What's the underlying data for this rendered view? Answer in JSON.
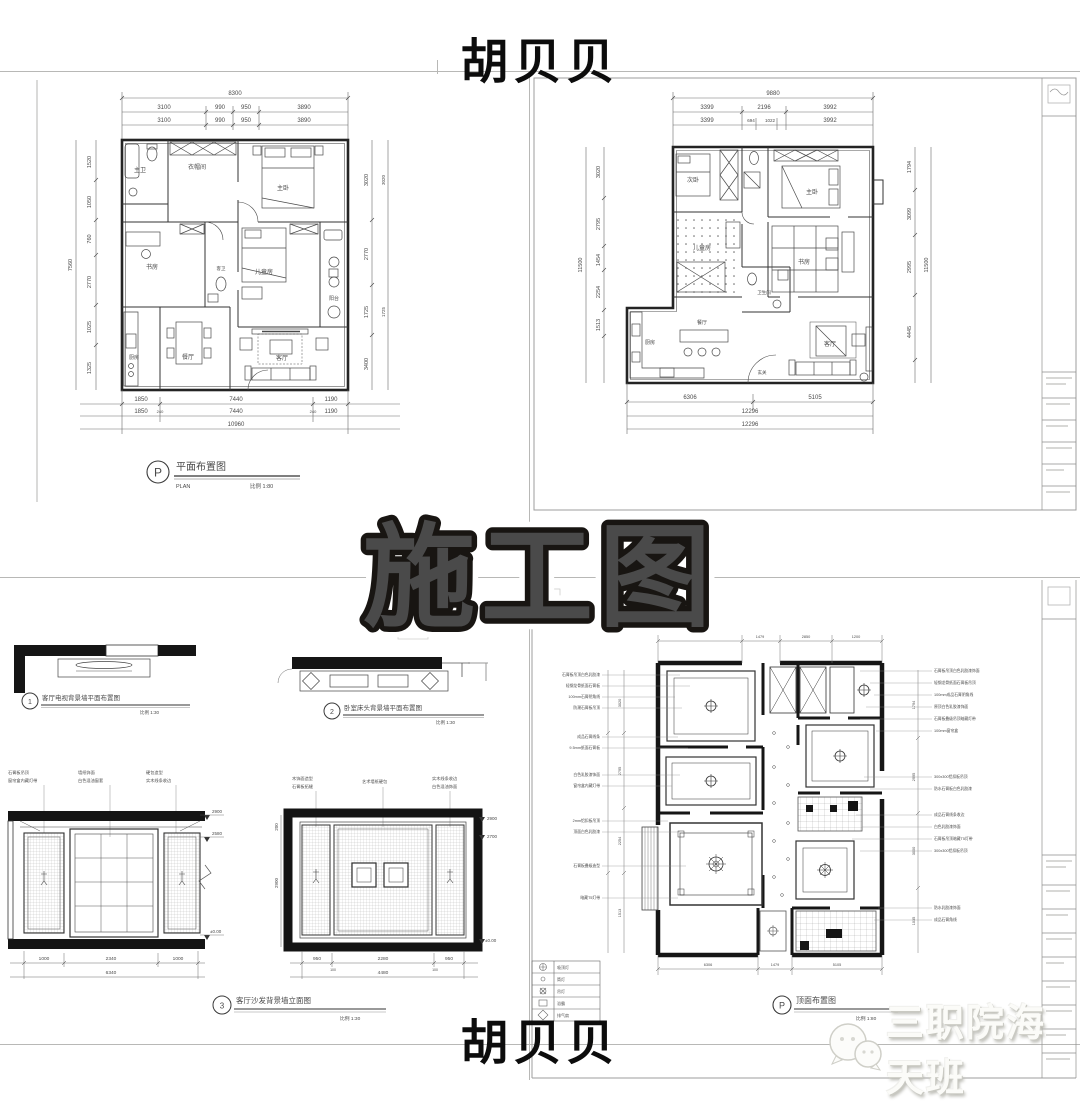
{
  "page": {
    "top_name": "胡贝贝",
    "bottom_name": "胡贝贝",
    "banner": "施工图",
    "watermark_text": "三职院海天班",
    "logo": "wechat-icon",
    "colors": {
      "banner_fill": "#F5C433",
      "banner_stroke": "#181512",
      "banner_halo": "#FFFFFF",
      "ink": "#303030",
      "dim_text": "#5a5a5a",
      "sheet_line": "#9E9E9E",
      "wall": "#1c1c1c",
      "watermark_fill": "#FBFBF8"
    }
  },
  "plan_tl": {
    "title_letter": "P",
    "title": "平面布置图",
    "title_en": "PLAN",
    "scale": "比例 1:80",
    "dim_top_total": "8300",
    "dim_top": [
      "3100",
      "990",
      "950",
      "3890"
    ],
    "dim_bottom": [
      "1850",
      "7440",
      "1190"
    ],
    "dim_bottom_small": "240",
    "dim_bottom_total": "10960",
    "dim_left": [
      "1520",
      "1050",
      "760",
      "2770",
      "1025",
      "1325"
    ],
    "dim_left_total": "7560",
    "dim_right": [
      "3020",
      "2770",
      "1725",
      "3400"
    ],
    "rooms": {
      "bath_m": "主卫",
      "cloak": "衣帽间",
      "master": "主卧",
      "study": "书房",
      "kids": "儿童房",
      "bath_g": "客卫",
      "dining": "餐厅",
      "kitchen": "厨房",
      "living": "客厅",
      "balcony": "阳台"
    }
  },
  "plan_tr": {
    "dim_top_total": "9880",
    "dim_top": [
      "3399",
      "2196",
      "3992"
    ],
    "dim_top2": [
      "3399",
      "694",
      "1022",
      "3992"
    ],
    "dim_bottom": [
      "6306",
      "5105"
    ],
    "dim_bottom_total": "12296",
    "dim_left": [
      "3020",
      "2795",
      "1454",
      "2254",
      "1513"
    ],
    "dim_left_total": "11500",
    "dim_right": [
      "1794",
      "3099",
      "2995",
      "4445"
    ],
    "dim_right_total": "11500",
    "rooms": {
      "second": "次卧",
      "master": "主卧",
      "kids": "儿童房",
      "study": "书房",
      "bath": "卫生间",
      "kitchen": "厨房",
      "dining": "餐厅",
      "living": "客厅",
      "entry": "玄关"
    }
  },
  "details_bl": {
    "a": {
      "no": "1",
      "title": "客厅电视背景墙平面布置图",
      "scale": "比例 1:30"
    },
    "b": {
      "no": "2",
      "title": "卧室床头背景墙平面布置图",
      "scale": "比例 1:30"
    },
    "elev_left": {
      "notes": [
        "石膏板吊顶",
        "窗帘盒内藏灯带",
        "墙纸饰面",
        "白色混油窗套",
        "硬包造型",
        "实木线条收边"
      ],
      "heights": [
        "2900",
        "2580",
        "±0.00"
      ],
      "dims": [
        "1000",
        "2340",
        "1000"
      ],
      "total": "6340"
    },
    "elev_right": {
      "notes": [
        "木饰面造型",
        "石膏板拓缝",
        "艺术墙纸硬包",
        "实木线条收边",
        "白色混油饰面"
      ],
      "height_left": "2900",
      "height_left_top": "200",
      "heights": [
        "2900",
        "2700",
        "±0.00"
      ],
      "dims": [
        "950",
        "2280",
        "950"
      ],
      "small": "100",
      "total": "4480"
    },
    "elev_title": {
      "no": "3",
      "title": "客厅沙发背景墙立面图",
      "scale": "比例 1:30"
    }
  },
  "ceiling_br": {
    "title_letter": "P",
    "title": "顶面布置图",
    "scale": "比例 1:80",
    "left_notes": [
      "石膏板吊顶白色乳胶漆",
      "轻钢龙骨纸面石膏板",
      "100mm石膏阴角线",
      "防潮石膏板吊顶",
      "成品石膏线条",
      "9.5mm纸面石膏板",
      "白色乳胶漆饰面",
      "窗帘盒内藏灯带",
      "2mm铝扣板吊顶",
      "顶面白色乳胶漆",
      "石膏板叠级造型",
      "暗藏T5灯带"
    ],
    "right_notes": [
      "石膏板吊顶白色乳胶漆饰面",
      "轻钢龙骨纸面石膏板吊顶",
      "100mm成品石膏阴角线",
      "原顶白色乳胶漆饰面",
      "石膏板叠级吊顶暗藏灯带",
      "100mm窗帘盒",
      "300x300铝扣板吊顶",
      "防水石膏板白色乳胶漆",
      "成品石膏线条收边",
      "白色乳胶漆饰面",
      "石膏板吊顶暗藏T5灯带",
      "300x300铝扣板吊顶",
      "防水乳胶漆饰面",
      "成品石膏角线"
    ],
    "dim_top": [
      "2460",
      "1479",
      "2850",
      "1200"
    ],
    "dim_left": [
      "3020",
      "2795",
      "2254",
      "1513"
    ],
    "dim_right": [
      "1794",
      "2995",
      "3000",
      "1035"
    ],
    "dim_bottom": [
      "6306",
      "1479",
      "5105"
    ],
    "legend": [
      "吸顶灯",
      "筒灯",
      "吊灯",
      "浴霸",
      "排气扇"
    ]
  }
}
